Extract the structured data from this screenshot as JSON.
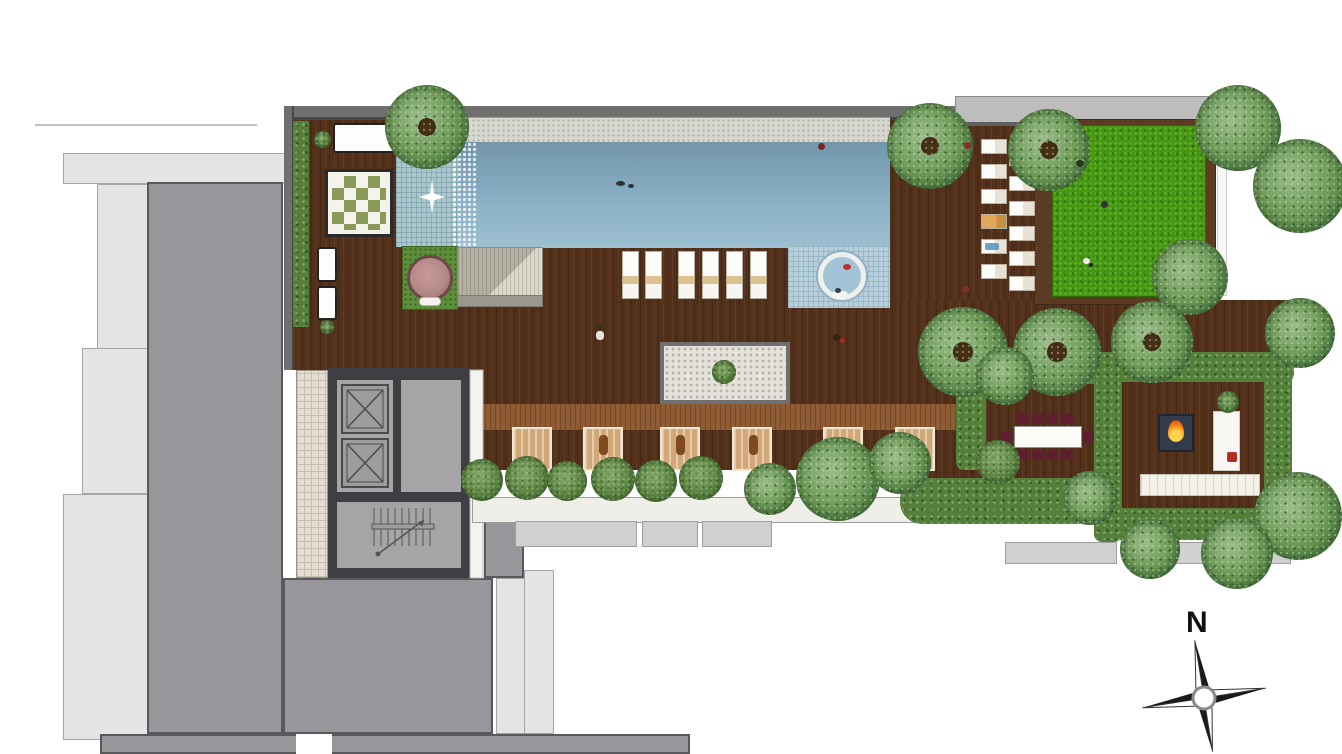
{
  "meta": {
    "title": "Rooftop Amenity Deck - Site Plan",
    "type": "architectural floor plan, top view"
  },
  "compass": {
    "north_label": "N"
  },
  "palette": {
    "deck_wood": "#53301a",
    "deck_walkway": "#8f5c33",
    "pool_water_deep": "#7396ab",
    "pool_water_light": "#9dc0d2",
    "pool_shallow": "#a9c7cd",
    "pool_tile": "#b7cfda",
    "coping_stone": "#d8d7d0",
    "lawn_green": "#459612",
    "tree_green": "#6f9c5a",
    "hedge_green": "#55803c",
    "building_gray": "#98969a",
    "building_light_gray": "#e4e4e2",
    "core_wall_gray": "#3f3e42",
    "room_gray": "#a6a4a7",
    "lounger_white": "#fbfbf8",
    "daybed_tan": "#d2a878",
    "dining_chair_maroon": "#5f1f30",
    "fire_orange": "#ff8c1a",
    "round_daybed_pink": "#b68989",
    "planter_white": "#efeee8"
  },
  "features": [
    "swimming-pool",
    "kids-shallow-pool",
    "waterfall-edge",
    "jacuzzi",
    "pool-coping",
    "timber-deck",
    "timber-walkway",
    "sun-loungers",
    "cabana-daybeds",
    "checker-spa-mat",
    "round-daybed",
    "stone-platform",
    "zen-stone-feature",
    "lawn",
    "planter-shrubs",
    "hedge-frames",
    "fire-pit-lounge",
    "outdoor-dining",
    "elevator-core",
    "stair-core",
    "tower-roof-below",
    "compass-north"
  ]
}
